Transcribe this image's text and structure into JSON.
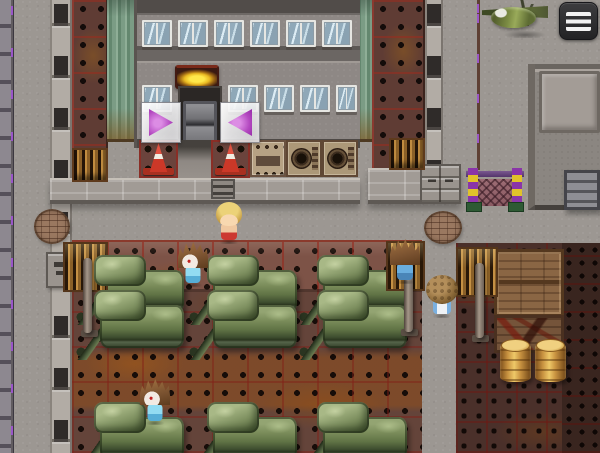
{
  "meta": {
    "app": "rpg-maker-style-game",
    "scene_description": "Military depot map: factory building with door, rows of green tanks on riveted metal floor, crates and barrels, NPC characters, chain gate, helicopter",
    "canvas": {
      "width": 600,
      "height": 453
    }
  },
  "ui": {
    "menu_button": {
      "icon": "hamburger-icon",
      "background": "#2d2d2f",
      "bar_color": "#f2f2f2"
    },
    "arrow_right_button": {
      "icon": "triangle-right-icon",
      "color": "#b348c0"
    },
    "arrow_left_button": {
      "icon": "triangle-left-icon",
      "color": "#b348c0"
    }
  },
  "palette": {
    "concrete": "#9c9792",
    "yard_floor": "#64443a",
    "yard_wall": "#7d5347",
    "crates_floor": "#4a302a",
    "tank_green": "#7c8e5c",
    "window_glass": "#93acbc",
    "awning_gold": "#ffe84a",
    "cone_red": "#cc3828",
    "barrel_tan": "#c89240",
    "gate_purple": "#8a35a8",
    "gate_yellow": "#e0c22a",
    "arrow_magenta": "#b348c0"
  },
  "scene": {
    "entities": [
      {
        "name": "concrete-ground",
        "type": "ground",
        "x": 0,
        "y": 0,
        "w": 600,
        "h": 453,
        "interactable": false
      },
      {
        "name": "tank-yard-floor",
        "type": "yard",
        "x": 72,
        "y": 240,
        "w": 350,
        "h": 213,
        "interactable": false
      },
      {
        "name": "tank-yard-wall",
        "type": "yardwall",
        "x": 72,
        "y": 240,
        "w": 350,
        "h": 52,
        "interactable": false
      },
      {
        "name": "crates-floor",
        "type": "cratesfloor",
        "x": 456,
        "y": 243,
        "w": 144,
        "h": 210,
        "interactable": false
      },
      {
        "name": "dark-floor-column",
        "type": "darkfloor",
        "x": 562,
        "y": 243,
        "w": 38,
        "h": 210,
        "interactable": false
      },
      {
        "name": "left-wall-strip",
        "type": "wallstrip",
        "x": 0,
        "y": 0,
        "w": 14,
        "h": 453,
        "interactable": false
      },
      {
        "name": "left-pillar-column",
        "type": "pillar",
        "x": 50,
        "y": 0,
        "w": 22,
        "h": 453,
        "interactable": false
      },
      {
        "name": "brown-column-left",
        "type": "browncol",
        "x": 72,
        "y": 0,
        "w": 36,
        "h": 186,
        "interactable": false
      },
      {
        "name": "green-column-left",
        "type": "greencol",
        "x": 107,
        "y": 0,
        "w": 27,
        "h": 142,
        "interactable": false
      },
      {
        "name": "green-column-right",
        "type": "greencol",
        "x": 356,
        "y": 0,
        "w": 16,
        "h": 142,
        "interactable": false
      },
      {
        "name": "brown-column-right",
        "type": "browncol",
        "x": 372,
        "y": 0,
        "w": 53,
        "h": 170,
        "interactable": false
      },
      {
        "name": "right-pillar-column",
        "type": "pillar",
        "x": 425,
        "y": 0,
        "w": 18,
        "h": 204,
        "interactable": false
      },
      {
        "name": "pavement-seam",
        "type": "seam",
        "x": 477,
        "y": 0,
        "w": 3,
        "h": 170,
        "interactable": false
      },
      {
        "name": "factory-building",
        "type": "building",
        "x": 134,
        "y": 0,
        "w": 226,
        "h": 148,
        "interactable": false
      },
      {
        "name": "right-building",
        "type": "building2",
        "x": 528,
        "y": 64,
        "w": 72,
        "h": 146,
        "interactable": false
      },
      {
        "name": "right-building-panel",
        "type": "bpanel",
        "x": 539,
        "y": 71,
        "w": 61,
        "h": 62,
        "interactable": false
      },
      {
        "name": "right-building-door",
        "type": "metaldoor",
        "x": 564,
        "y": 170,
        "w": 36,
        "h": 40,
        "interactable": true
      },
      {
        "name": "ledge-left",
        "type": "ledge",
        "x": 50,
        "y": 178,
        "w": 310,
        "h": 26,
        "interactable": false
      },
      {
        "name": "ledge-right",
        "type": "ledge",
        "x": 368,
        "y": 168,
        "w": 93,
        "h": 36,
        "interactable": false
      },
      {
        "name": "drawer-cabinet",
        "type": "cabinet",
        "x": 420,
        "y": 164,
        "w": 41,
        "h": 40,
        "interactable": false
      },
      {
        "name": "window-row1-1",
        "type": "window",
        "x": 142,
        "y": 20,
        "w": 30,
        "h": 27,
        "interactable": false
      },
      {
        "name": "window-row1-2",
        "type": "window",
        "x": 178,
        "y": 20,
        "w": 30,
        "h": 27,
        "interactable": false
      },
      {
        "name": "window-row1-3",
        "type": "window",
        "x": 214,
        "y": 20,
        "w": 30,
        "h": 27,
        "interactable": false
      },
      {
        "name": "window-row1-4",
        "type": "window",
        "x": 250,
        "y": 20,
        "w": 30,
        "h": 27,
        "interactable": false
      },
      {
        "name": "window-row1-5",
        "type": "window",
        "x": 286,
        "y": 20,
        "w": 30,
        "h": 27,
        "interactable": false
      },
      {
        "name": "window-row1-6",
        "type": "window",
        "x": 322,
        "y": 20,
        "w": 30,
        "h": 27,
        "interactable": false
      },
      {
        "name": "window-row2-1",
        "type": "window",
        "x": 142,
        "y": 85,
        "w": 30,
        "h": 27,
        "interactable": false
      },
      {
        "name": "window-row2-2",
        "type": "window",
        "x": 228,
        "y": 85,
        "w": 30,
        "h": 27,
        "interactable": false
      },
      {
        "name": "window-row2-3",
        "type": "window",
        "x": 264,
        "y": 85,
        "w": 30,
        "h": 27,
        "interactable": false
      },
      {
        "name": "window-row2-4",
        "type": "window",
        "x": 300,
        "y": 85,
        "w": 30,
        "h": 27,
        "interactable": false
      },
      {
        "name": "window-row2-5",
        "type": "window",
        "x": 336,
        "y": 85,
        "w": 21,
        "h": 27,
        "interactable": false
      },
      {
        "name": "door-awning",
        "type": "awning",
        "x": 175,
        "y": 65,
        "w": 44,
        "h": 24,
        "interactable": false
      },
      {
        "name": "door-opening",
        "type": "dooropen",
        "x": 178,
        "y": 86,
        "w": 44,
        "h": 62,
        "interactable": false
      },
      {
        "name": "factory-door",
        "type": "doorpanel",
        "x": 183,
        "y": 101,
        "w": 34,
        "h": 47,
        "interactable": true
      },
      {
        "name": "door-step",
        "type": "doorstep",
        "x": 177,
        "y": 140,
        "w": 35,
        "h": 38,
        "interactable": false
      },
      {
        "name": "traffic-cone-1",
        "type": "conetile",
        "x": 139,
        "y": 140,
        "w": 39,
        "h": 38,
        "interactable": false
      },
      {
        "name": "traffic-cone-2",
        "type": "conetile",
        "x": 211,
        "y": 140,
        "w": 39,
        "h": 38,
        "interactable": false
      },
      {
        "name": "radio-box",
        "type": "radio",
        "x": 250,
        "y": 140,
        "w": 36,
        "h": 37,
        "interactable": false
      },
      {
        "name": "speaker-box-1",
        "type": "speaker",
        "x": 286,
        "y": 140,
        "w": 36,
        "h": 37,
        "interactable": false
      },
      {
        "name": "speaker-box-2",
        "type": "speaker",
        "x": 322,
        "y": 140,
        "w": 36,
        "h": 37,
        "interactable": false
      },
      {
        "name": "vent-box",
        "type": "ventbox",
        "x": 211,
        "y": 179,
        "w": 24,
        "h": 20,
        "interactable": false
      },
      {
        "name": "grate-tile-left",
        "type": "gratetile",
        "x": 72,
        "y": 148,
        "w": 36,
        "h": 34,
        "interactable": false
      },
      {
        "name": "grate-tile-right",
        "type": "gratetile",
        "x": 389,
        "y": 138,
        "w": 36,
        "h": 32,
        "interactable": false
      },
      {
        "name": "pipe-machine-1",
        "type": "machine",
        "x": 63,
        "y": 242,
        "w": 45,
        "h": 50,
        "interactable": false
      },
      {
        "name": "pipe-machine-2",
        "type": "machine",
        "x": 386,
        "y": 241,
        "w": 39,
        "h": 50,
        "interactable": false
      },
      {
        "name": "pipe-machine-3",
        "type": "machine",
        "x": 456,
        "y": 247,
        "w": 42,
        "h": 50,
        "interactable": false
      },
      {
        "name": "control-box",
        "type": "controlbox",
        "x": 46,
        "y": 252,
        "w": 32,
        "h": 36,
        "interactable": false
      },
      {
        "name": "manhole-left",
        "type": "manhole",
        "x": 34,
        "y": 209,
        "w": 36,
        "h": 35,
        "interactable": false
      },
      {
        "name": "manhole-right",
        "type": "manhole",
        "x": 424,
        "y": 211,
        "w": 38,
        "h": 33,
        "interactable": false
      },
      {
        "name": "chain-gate",
        "type": "gate",
        "x": 466,
        "y": 165,
        "w": 58,
        "h": 47,
        "interactable": false
      },
      {
        "name": "helicopter",
        "type": "helicopter",
        "x": 482,
        "y": 0,
        "w": 78,
        "h": 38,
        "interactable": false
      },
      {
        "name": "crate-stack",
        "type": "cratestack",
        "x": 494,
        "y": 249,
        "w": 70,
        "h": 68,
        "interactable": false
      },
      {
        "name": "crate-marked",
        "type": "cratemarked",
        "x": 494,
        "y": 315,
        "w": 70,
        "h": 38,
        "interactable": false
      },
      {
        "name": "barrel-1",
        "type": "barrel",
        "x": 500,
        "y": 341,
        "w": 31,
        "h": 41,
        "interactable": false
      },
      {
        "name": "barrel-2",
        "type": "barrel",
        "x": 535,
        "y": 341,
        "w": 31,
        "h": 41,
        "interactable": false
      },
      {
        "name": "tank-row1-a",
        "type": "tank",
        "x": 73,
        "y": 255,
        "w": 114,
        "h": 70,
        "interactable": false
      },
      {
        "name": "tank-row1-b",
        "type": "tank",
        "x": 186,
        "y": 255,
        "w": 114,
        "h": 70,
        "interactable": false
      },
      {
        "name": "tank-row1-c",
        "type": "tank",
        "x": 296,
        "y": 255,
        "w": 114,
        "h": 70,
        "interactable": false
      },
      {
        "name": "tank-row2-a",
        "type": "tank",
        "x": 73,
        "y": 290,
        "w": 114,
        "h": 70,
        "interactable": false
      },
      {
        "name": "tank-row2-b",
        "type": "tank",
        "x": 186,
        "y": 290,
        "w": 114,
        "h": 70,
        "interactable": false
      },
      {
        "name": "tank-row2-c",
        "type": "tank",
        "x": 296,
        "y": 290,
        "w": 114,
        "h": 70,
        "interactable": false
      },
      {
        "name": "npc-blonde",
        "type": "char charblonde",
        "x": 214,
        "y": 202,
        "w": 30,
        "h": 42,
        "interactable": true
      },
      {
        "name": "npc-spiky-hair-1",
        "type": "char charspiky",
        "x": 176,
        "y": 242,
        "w": 34,
        "h": 45,
        "interactable": true
      },
      {
        "name": "npc-spiky-hair-2",
        "type": "char charback",
        "x": 388,
        "y": 239,
        "w": 34,
        "h": 45,
        "interactable": true
      },
      {
        "name": "npc-afro-hair",
        "type": "char charafro",
        "x": 424,
        "y": 275,
        "w": 36,
        "h": 43,
        "interactable": true
      },
      {
        "name": "npc-spiky-hair-3",
        "type": "char charspiky",
        "x": 138,
        "y": 379,
        "w": 34,
        "h": 46,
        "interactable": true
      },
      {
        "name": "tank-row3-a",
        "type": "tank",
        "x": 73,
        "y": 402,
        "w": 114,
        "h": 70,
        "interactable": false
      },
      {
        "name": "tank-row3-b",
        "type": "tank",
        "x": 186,
        "y": 402,
        "w": 114,
        "h": 70,
        "interactable": false
      },
      {
        "name": "tank-row3-c",
        "type": "tank",
        "x": 296,
        "y": 402,
        "w": 114,
        "h": 70,
        "interactable": false
      }
    ]
  }
}
